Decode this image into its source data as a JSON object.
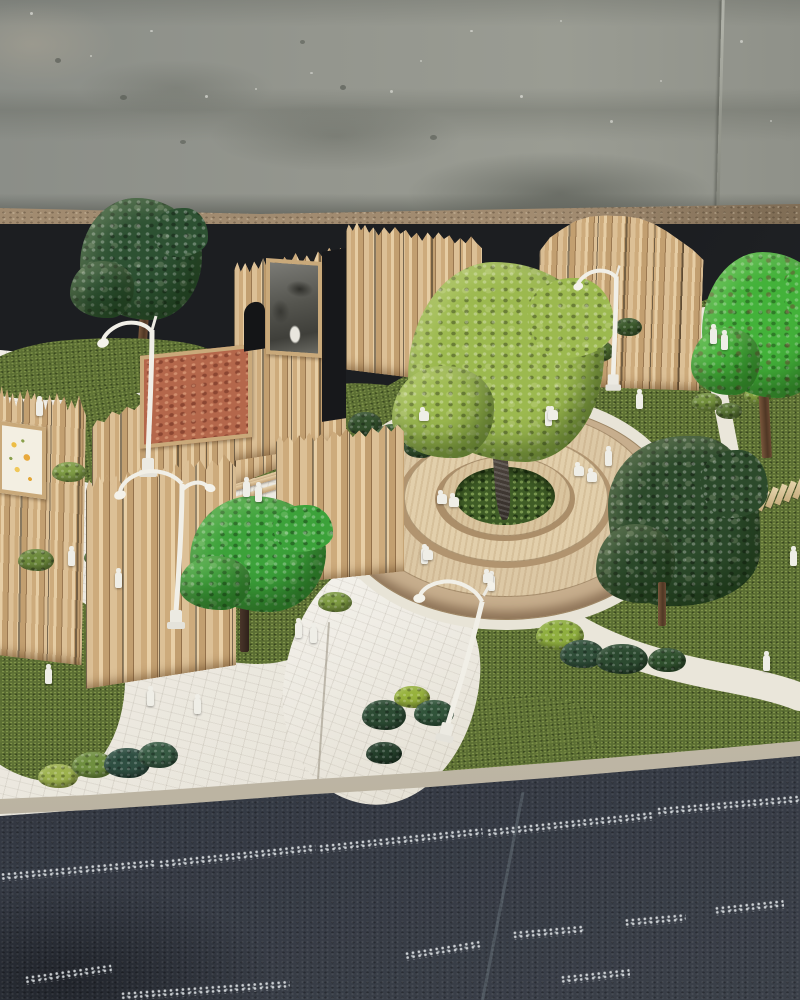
{
  "scene": {
    "type": "photograph",
    "subject": "Architectural scale model of a landscaped public park plaza, photographed on a dark table in front of a concrete wall",
    "elements": [
      "concrete wall backdrop with stains and a vertical crack",
      "terrazzo floor strip",
      "dark table surface",
      "asphalt-textured base with white chalk speckle lines and a diagonal seam",
      "balsa-wood slat fence walls",
      "cork notice board panel",
      "framed monochrome photo panel",
      "framed yellow botanical print",
      "arched doorway opening in fence",
      "circular tiered wooden planter plaza",
      "central tree in moss-filled planter",
      "artificial turf lawns",
      "white brick-textured pathways",
      "wooden plank stepping path",
      "white scale figures standing and sitting",
      "white curved street lamps",
      "model trees and moss shrubs"
    ],
    "counts": {
      "lamps": 4,
      "large_trees": 5,
      "figures": 27,
      "fence_segments": 7,
      "stepping_planks": 8,
      "wall_art_panels": 3
    }
  },
  "palette": {
    "wall": "#8e918b",
    "terrazzo": "#a18b70",
    "table": "#1c1e21",
    "asphalt": "#2f333b",
    "turf": "#5b6e33",
    "pavement": "#ebe7dc",
    "wood": "#cfae82",
    "plywood": "#dcc8a5",
    "plywood-face": "#b1946f",
    "cork": "#b4674b",
    "moss": "#3f5c26",
    "tree-lime": "#9cb94f",
    "tree-bright": "#3ca23a",
    "tree-dark": "#2d5132",
    "tree-deep": "#2c4a2b",
    "figure": "#efeee7",
    "lamp": "#f1efe7",
    "chalk": "#e9edef"
  },
  "shapes": [
    {
      "host": "#wall",
      "class": "wdot",
      "name": "wall-speckle",
      "items": [
        {
          "x": 30,
          "y": 12,
          "w": 3,
          "h": 3,
          "c": "rgba(245,245,240,.55)"
        },
        {
          "x": 90,
          "y": 55,
          "w": 2,
          "h": 2,
          "c": "rgba(245,245,240,.5)"
        },
        {
          "x": 150,
          "y": 30,
          "w": 3,
          "h": 2,
          "c": "rgba(245,245,240,.5)"
        },
        {
          "x": 205,
          "y": 95,
          "w": 3,
          "h": 3,
          "c": "rgba(245,245,240,.55)"
        },
        {
          "x": 255,
          "y": 88,
          "w": 2,
          "h": 2,
          "c": "rgba(245,245,240,.5)"
        },
        {
          "x": 310,
          "y": 72,
          "w": 3,
          "h": 2,
          "c": "rgba(245,245,240,.45)"
        },
        {
          "x": 390,
          "y": 90,
          "w": 3,
          "h": 3,
          "c": "rgba(245,245,240,.5)"
        },
        {
          "x": 420,
          "y": 60,
          "w": 2,
          "h": 2,
          "c": "rgba(245,245,240,.45)"
        },
        {
          "x": 470,
          "y": 30,
          "w": 3,
          "h": 2,
          "c": "rgba(245,245,240,.5)"
        },
        {
          "x": 520,
          "y": 95,
          "w": 3,
          "h": 3,
          "c": "rgba(245,245,240,.55)"
        },
        {
          "x": 560,
          "y": 20,
          "w": 2,
          "h": 2,
          "c": "rgba(245,245,240,.45)"
        },
        {
          "x": 610,
          "y": 120,
          "w": 3,
          "h": 3,
          "c": "rgba(245,245,240,.5)"
        },
        {
          "x": 660,
          "y": 80,
          "w": 2,
          "h": 2,
          "c": "rgba(245,245,240,.45)"
        },
        {
          "x": 740,
          "y": 40,
          "w": 3,
          "h": 3,
          "c": "rgba(245,245,240,.5)"
        },
        {
          "x": 770,
          "y": 120,
          "w": 2,
          "h": 2,
          "c": "rgba(245,245,240,.45)"
        },
        {
          "x": 55,
          "y": 58,
          "w": 6,
          "h": 5,
          "c": "rgba(60,64,58,.45)"
        },
        {
          "x": 120,
          "y": 95,
          "w": 7,
          "h": 5,
          "c": "rgba(60,64,58,.4)"
        },
        {
          "x": 340,
          "y": 85,
          "w": 6,
          "h": 5,
          "c": "rgba(60,64,58,.45)"
        },
        {
          "x": 300,
          "y": 40,
          "w": 5,
          "h": 4,
          "c": "rgba(60,64,58,.4)"
        },
        {
          "x": 430,
          "y": 135,
          "w": 7,
          "h": 5,
          "c": "rgba(60,64,58,.4)"
        },
        {
          "x": 180,
          "y": 140,
          "w": 6,
          "h": 4,
          "c": "rgba(60,64,58,.4)"
        }
      ]
    },
    {
      "host": "#ground-blobs",
      "class": "gblob grass-tex",
      "name": "turf-lawn",
      "items": [
        {
          "x": -25,
          "y": 338,
          "w": 245,
          "h": 60,
          "r": -4,
          "br": "40% 60% 55% 45%/60% 50% 50% 40%"
        },
        {
          "x": -20,
          "y": 452,
          "w": 100,
          "h": 118,
          "br": "50% 50% 45% 55%/55% 45% 55% 45%"
        },
        {
          "x": 50,
          "y": 386,
          "w": 110,
          "h": 96,
          "r": -8,
          "br": "45% 55% 60% 40%/50% 45% 55% 50%"
        },
        {
          "x": 146,
          "y": 512,
          "w": 205,
          "h": 152,
          "br": "48% 52% 45% 55%/55% 48% 52% 45%"
        },
        {
          "x": -35,
          "y": 592,
          "w": 160,
          "h": 190,
          "br": "50% 50% 42% 58%/58% 46% 54% 42%"
        },
        {
          "x": 192,
          "y": 386,
          "w": 240,
          "h": 88,
          "r": -9,
          "br": "45% 55% 50% 50%/60% 45% 55% 40%"
        },
        {
          "x": 430,
          "y": 695,
          "w": 170,
          "h": 85,
          "r": -4,
          "br": "45% 55% 50% 50%/55% 45% 55% 45%"
        }
      ]
    },
    {
      "host": "#ground-blobs",
      "class": "gblob pave-tex",
      "name": "pavement-patch",
      "items": [
        {
          "x": 284,
          "y": 560,
          "w": 195,
          "h": 245,
          "r": 6,
          "br": "45% 55% 50% 50%/55% 45% 55% 45%"
        }
      ]
    },
    {
      "host": "#tuft-layer",
      "class": "tuft",
      "name": "moss-shrub",
      "items": [
        {
          "x": 52,
          "y": 462,
          "w": 34,
          "h": 20,
          "c": "#7f9c45"
        },
        {
          "x": 18,
          "y": 549,
          "w": 36,
          "h": 22,
          "c": "#6d8a3c"
        },
        {
          "x": 84,
          "y": 548,
          "w": 30,
          "h": 18,
          "c": "#55743a"
        },
        {
          "x": 292,
          "y": 487,
          "w": 30,
          "h": 19,
          "c": "#8fae49"
        },
        {
          "x": 318,
          "y": 592,
          "w": 34,
          "h": 20,
          "c": "#7d9a41"
        },
        {
          "x": 348,
          "y": 412,
          "w": 34,
          "h": 24,
          "c": "#33502c"
        },
        {
          "x": 374,
          "y": 424,
          "w": 38,
          "h": 26,
          "c": "#3a5a30"
        },
        {
          "x": 404,
          "y": 436,
          "w": 32,
          "h": 22,
          "c": "#2f4c2a"
        },
        {
          "x": 338,
          "y": 462,
          "w": 40,
          "h": 26,
          "c": "#4a6834"
        },
        {
          "x": 556,
          "y": 330,
          "w": 30,
          "h": 20,
          "c": "#5d7c35"
        },
        {
          "x": 580,
          "y": 340,
          "w": 34,
          "h": 22,
          "c": "#4e6c2f"
        },
        {
          "x": 614,
          "y": 318,
          "w": 28,
          "h": 18,
          "c": "#3c5a2c"
        },
        {
          "x": 692,
          "y": 393,
          "w": 30,
          "h": 18,
          "c": "#74913d"
        },
        {
          "x": 716,
          "y": 403,
          "w": 26,
          "h": 16,
          "c": "#5a7634"
        },
        {
          "x": 744,
          "y": 386,
          "w": 30,
          "h": 18,
          "c": "#86a441"
        },
        {
          "x": 536,
          "y": 620,
          "w": 48,
          "h": 30,
          "c": "#8fae3f"
        },
        {
          "x": 560,
          "y": 640,
          "w": 44,
          "h": 28,
          "c": "#31503a"
        },
        {
          "x": 596,
          "y": 644,
          "w": 52,
          "h": 30,
          "c": "#2c4a30"
        },
        {
          "x": 648,
          "y": 648,
          "w": 38,
          "h": 24,
          "c": "#30512e"
        },
        {
          "x": 38,
          "y": 764,
          "w": 40,
          "h": 24,
          "c": "#9cb14d"
        },
        {
          "x": 72,
          "y": 752,
          "w": 42,
          "h": 26,
          "c": "#6f8f3f"
        },
        {
          "x": 104,
          "y": 748,
          "w": 46,
          "h": 30,
          "c": "#2f4f42"
        },
        {
          "x": 138,
          "y": 742,
          "w": 40,
          "h": 26,
          "c": "#375a43"
        },
        {
          "x": 362,
          "y": 700,
          "w": 44,
          "h": 30,
          "c": "#2c4b33"
        },
        {
          "x": 394,
          "y": 686,
          "w": 36,
          "h": 22,
          "c": "#97b23c"
        },
        {
          "x": 414,
          "y": 700,
          "w": 40,
          "h": 26,
          "c": "#31543a"
        },
        {
          "x": 366,
          "y": 742,
          "w": 36,
          "h": 22,
          "c": "#243f2b"
        }
      ]
    },
    {
      "host": "#plank-layer",
      "class": "plank",
      "name": "stepping-plank",
      "items": [
        {
          "x": 733,
          "y": 500,
          "r": 22
        },
        {
          "x": 742,
          "y": 497,
          "r": 22
        },
        {
          "x": 751,
          "y": 494,
          "r": 22
        },
        {
          "x": 760,
          "y": 490,
          "r": 22
        },
        {
          "x": 769,
          "y": 487,
          "r": 22
        },
        {
          "x": 778,
          "y": 484,
          "r": 22
        },
        {
          "x": 787,
          "y": 481,
          "r": 22
        },
        {
          "x": 796,
          "y": 478,
          "r": 22
        }
      ]
    },
    {
      "host": "#figure-layer",
      "class": "fig",
      "name": "scale-figure-standing",
      "items": [
        {
          "x": 36,
          "y": 400
        },
        {
          "x": 115,
          "y": 572
        },
        {
          "x": 68,
          "y": 550
        },
        {
          "x": 45,
          "y": 668
        },
        {
          "x": 147,
          "y": 690
        },
        {
          "x": 194,
          "y": 698
        },
        {
          "x": 243,
          "y": 481
        },
        {
          "x": 255,
          "y": 486
        },
        {
          "x": 295,
          "y": 622
        },
        {
          "x": 310,
          "y": 627
        },
        {
          "x": 421,
          "y": 548
        },
        {
          "x": 488,
          "y": 575
        },
        {
          "x": 545,
          "y": 410
        },
        {
          "x": 605,
          "y": 450
        },
        {
          "x": 636,
          "y": 393
        },
        {
          "x": 710,
          "y": 328
        },
        {
          "x": 721,
          "y": 334
        },
        {
          "x": 763,
          "y": 655
        },
        {
          "x": 790,
          "y": 550
        }
      ]
    },
    {
      "host": "#figure-layer",
      "class": "fig sit",
      "name": "scale-figure-sitting",
      "items": [
        {
          "x": 437,
          "y": 494
        },
        {
          "x": 449,
          "y": 497
        },
        {
          "x": 574,
          "y": 466
        },
        {
          "x": 587,
          "y": 472
        },
        {
          "x": 419,
          "y": 411
        },
        {
          "x": 548,
          "y": 410
        },
        {
          "x": 483,
          "y": 573
        },
        {
          "x": 423,
          "y": 550
        }
      ]
    },
    {
      "host": "#asphalt",
      "class": "chalk",
      "name": "chalk-speckle-line",
      "items": [
        {
          "x": 0,
          "y": 866,
          "w": 155,
          "r": -5
        },
        {
          "x": 158,
          "y": 852,
          "w": 158,
          "r": -6
        },
        {
          "x": 318,
          "y": 836,
          "w": 165,
          "r": -6
        },
        {
          "x": 486,
          "y": 820,
          "w": 168,
          "r": -6
        },
        {
          "x": 656,
          "y": 801,
          "w": 146,
          "r": -5
        },
        {
          "x": 512,
          "y": 928,
          "w": 72,
          "r": -5
        },
        {
          "x": 624,
          "y": 916,
          "w": 62,
          "r": -5
        },
        {
          "x": 714,
          "y": 903,
          "w": 70,
          "r": -6
        },
        {
          "x": 404,
          "y": 946,
          "w": 78,
          "r": -9
        },
        {
          "x": 24,
          "y": 970,
          "w": 88,
          "r": -8
        },
        {
          "x": 560,
          "y": 972,
          "w": 70,
          "r": -6
        },
        {
          "x": 120,
          "y": 986,
          "w": 170,
          "r": -4
        }
      ]
    }
  ]
}
